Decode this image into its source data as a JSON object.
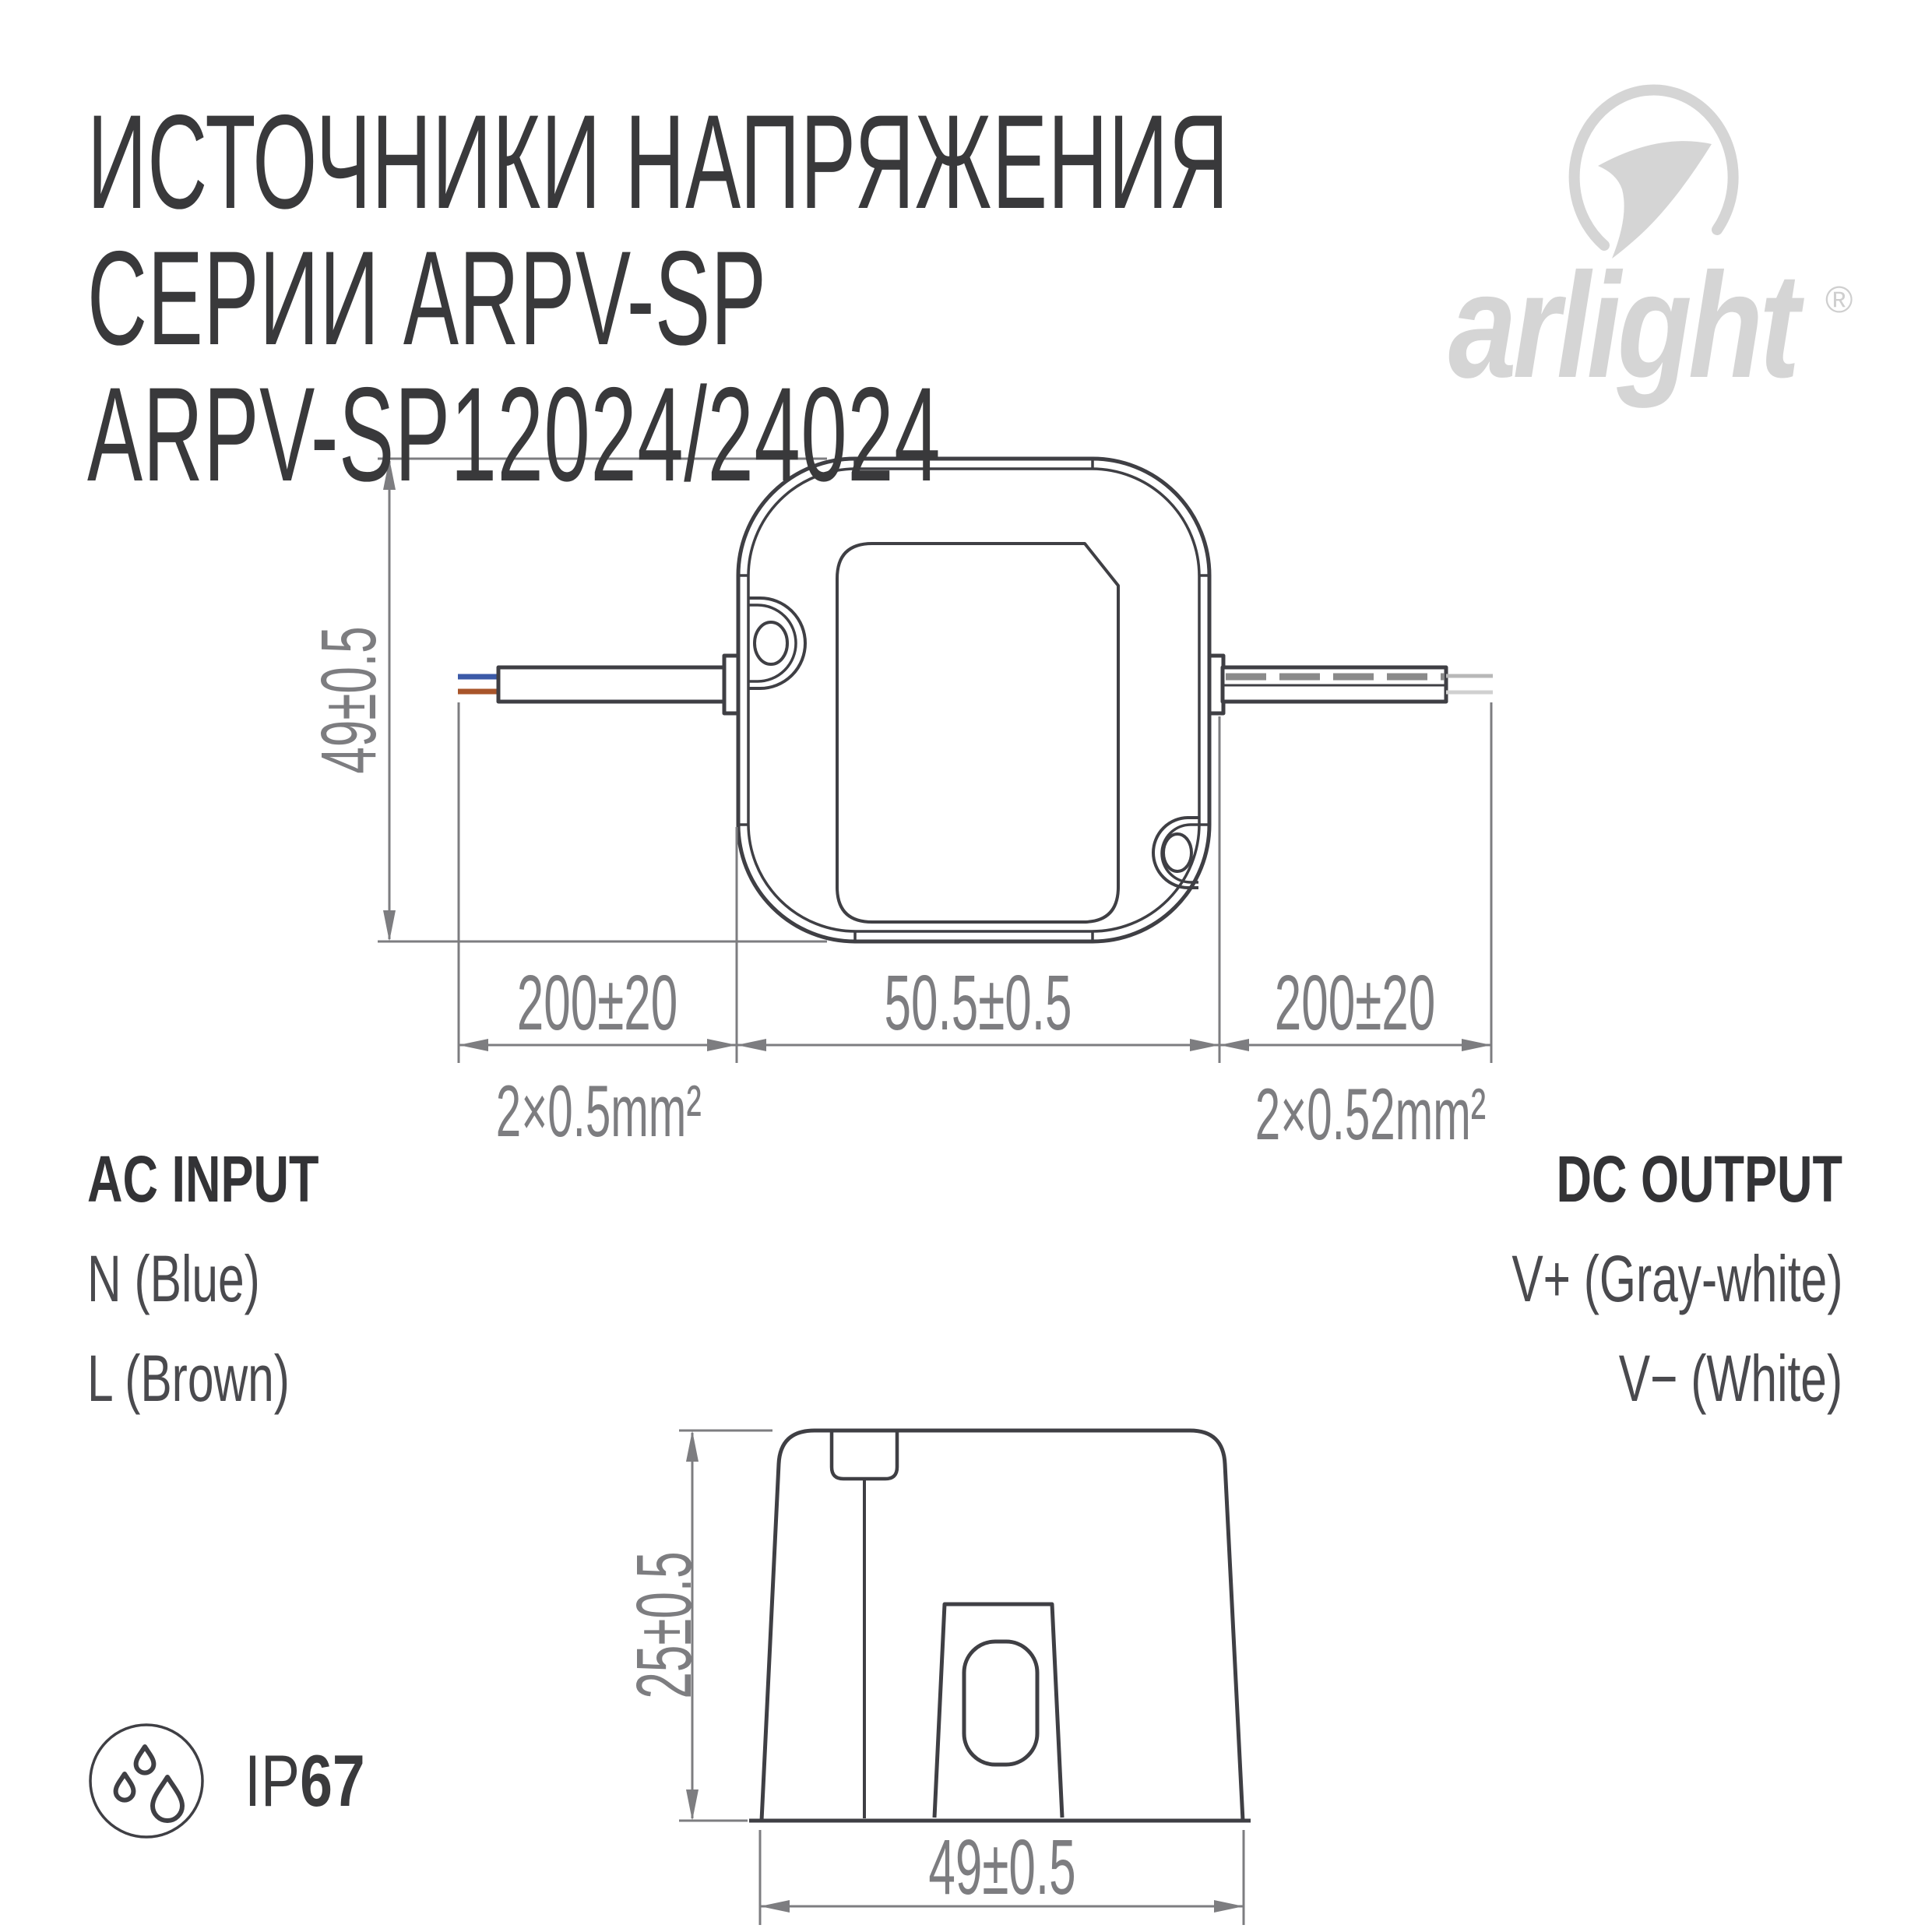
{
  "title": {
    "line1": "ИСТОЧНИКИ НАПРЯЖЕНИЯ",
    "line2": "СЕРИИ ARPV-SP",
    "line3": "ARPV-SP12024/24024"
  },
  "logo": {
    "brand": "arlight",
    "registered": "®"
  },
  "top_view": {
    "height_dim": "49±0.5",
    "left_wire_dim": "200±20",
    "body_dim": "50.5±0.5",
    "right_wire_dim": "200±20",
    "left_wire_spec": "2×0.5mm²",
    "right_wire_spec": "2×0.52mm²"
  },
  "side_view": {
    "height_dim": "25±0.5",
    "width_dim": "49±0.5"
  },
  "connections": {
    "input_title": "AC INPUT",
    "input_lines": [
      "N (Blue)",
      "L (Brown)"
    ],
    "output_title": "DC OUTPUT",
    "output_lines": [
      "V+ (Gray-white)",
      "V− (White)"
    ]
  },
  "badge": {
    "prefix": "IP",
    "rating": "67"
  },
  "colors": {
    "line": "#3f3f44",
    "dimension": "#7d7d80",
    "logo": "#d5d5d5",
    "wire_blue": "#3b5aa8",
    "wire_brown": "#a8552a",
    "wire_gray_dash": "#8a8a8a",
    "wire_light": "#c9c9c9"
  }
}
